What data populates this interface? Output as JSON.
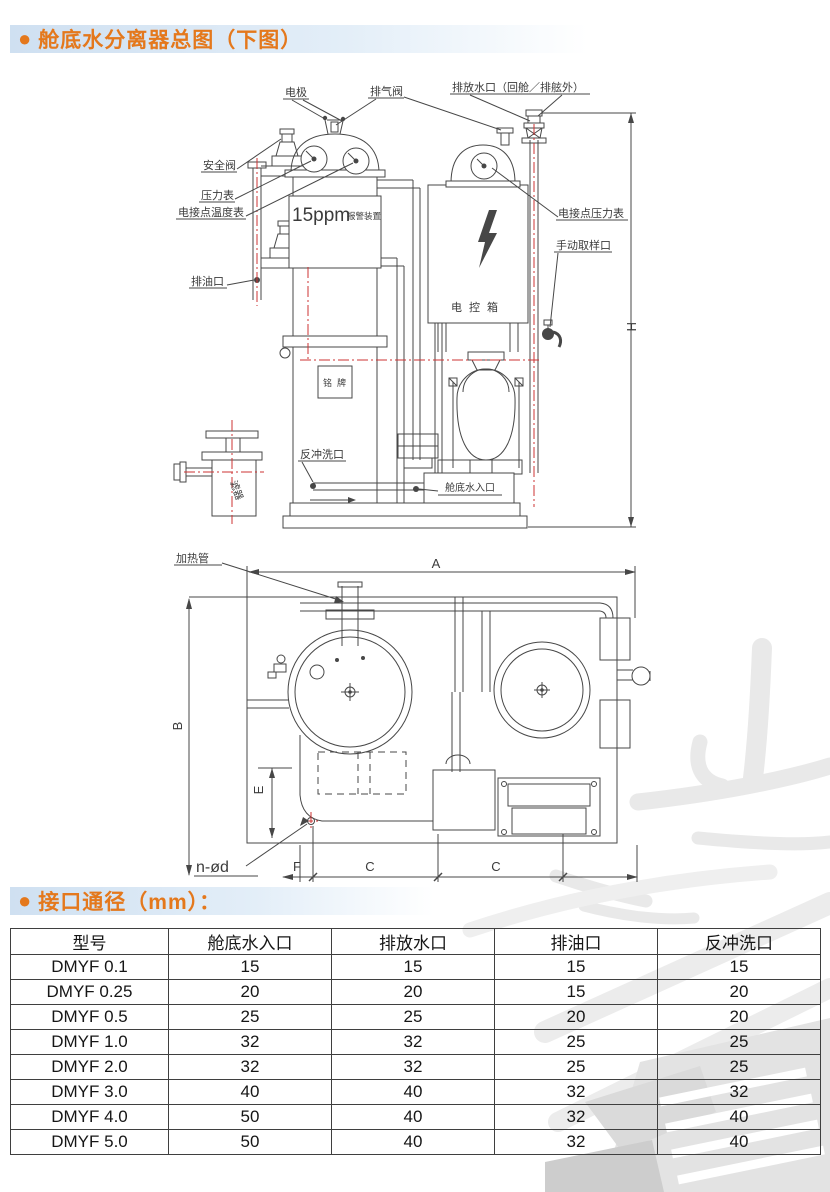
{
  "section1": {
    "bullet": "●",
    "title": "舱底水分离器总图（下图）"
  },
  "section2": {
    "bullet": "●",
    "title": "接口通径（mm）："
  },
  "diagram1": {
    "labels": {
      "electrode": "电极",
      "vent_valve": "排气阀",
      "discharge_port": "排放水口（回舱／排舷外）",
      "safety_valve": "安全阀",
      "pressure_gauge": "压力表",
      "contact_thermometer": "电接点温度表",
      "oil_drain_port": "排油口",
      "ppm_value": "15ppm",
      "ppm_device": "报警装置",
      "contact_pressure_gauge": "电接点压力表",
      "manual_sampling_port": "手动取样口",
      "control_box": "电控箱",
      "nameplate": "铭牌",
      "backwash_port": "反冲洗口",
      "bilge_inlet": "舱底水入口",
      "filter": "滤器",
      "dim_h": "H"
    }
  },
  "diagram2": {
    "labels": {
      "heating_pipe": "加热管",
      "dim_a": "A",
      "dim_b": "B",
      "dim_e": "E",
      "dim_f": "F",
      "dim_c_left": "C",
      "dim_c_right": "C",
      "hole_spec": "n-ød"
    }
  },
  "connection_table": {
    "headers": [
      "型号",
      "舱底水入口",
      "排放水口",
      "排油口",
      "反冲洗口"
    ],
    "rows": [
      {
        "model": "DMYF 0.1",
        "bilge_inlet": "15",
        "discharge": "15",
        "oil_drain": "15",
        "backwash": "15"
      },
      {
        "model": "DMYF 0.25",
        "bilge_inlet": "20",
        "discharge": "20",
        "oil_drain": "15",
        "backwash": "20"
      },
      {
        "model": "DMYF 0.5",
        "bilge_inlet": "25",
        "discharge": "25",
        "oil_drain": "20",
        "backwash": "20"
      },
      {
        "model": "DMYF 1.0",
        "bilge_inlet": "32",
        "discharge": "32",
        "oil_drain": "25",
        "backwash": "25"
      },
      {
        "model": "DMYF 2.0",
        "bilge_inlet": "32",
        "discharge": "32",
        "oil_drain": "25",
        "backwash": "25"
      },
      {
        "model": "DMYF 3.0",
        "bilge_inlet": "40",
        "discharge": "40",
        "oil_drain": "32",
        "backwash": "32"
      },
      {
        "model": "DMYF 4.0",
        "bilge_inlet": "50",
        "discharge": "40",
        "oil_drain": "32",
        "backwash": "40"
      },
      {
        "model": "DMYF 5.0",
        "bilge_inlet": "50",
        "discharge": "40",
        "oil_drain": "32",
        "backwash": "40"
      }
    ]
  },
  "colors": {
    "accent": "#e4781c",
    "line": "#474747",
    "centerline": "#cc3333",
    "header_band": "#cfe0f1",
    "watermark": "#e9e9e9"
  }
}
